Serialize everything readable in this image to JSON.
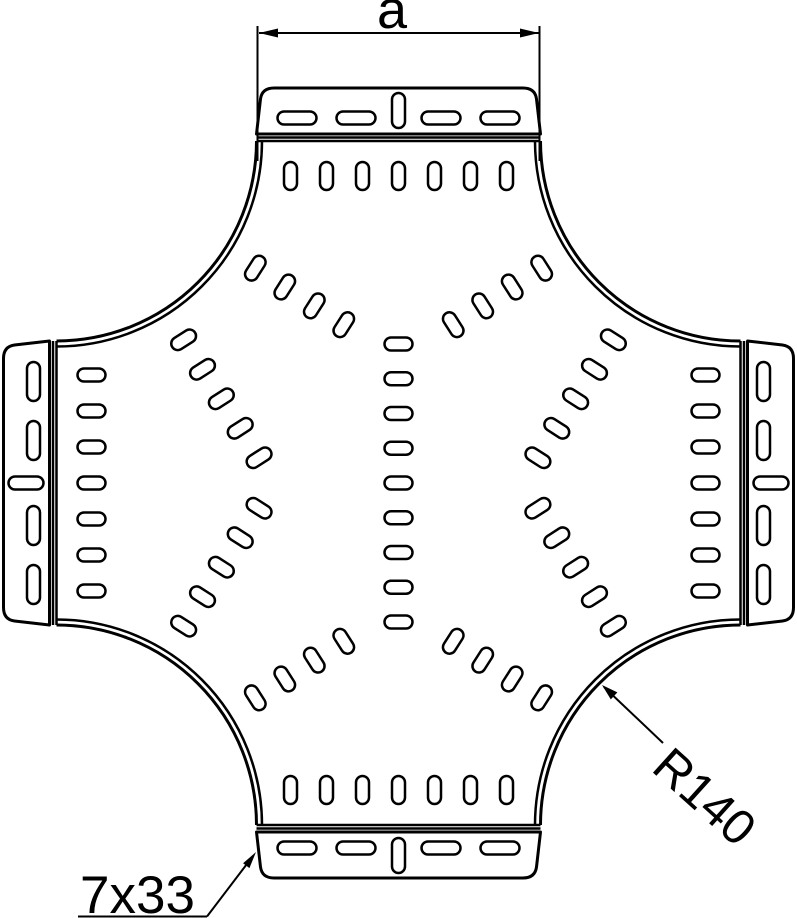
{
  "labels": {
    "dimension_a": "a",
    "corner_radius": "R140",
    "slot_size": "7x33"
  }
}
